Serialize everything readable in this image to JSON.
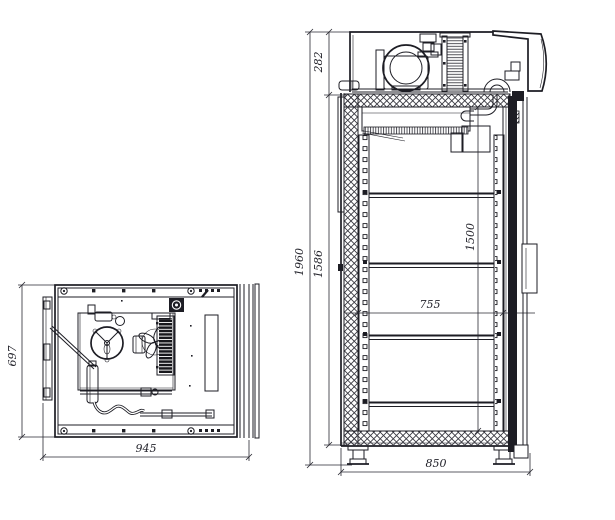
{
  "drawing_title": "Refrigerated cabinet technical drawing — plan view and front section",
  "plan_view": {
    "depth_mm": "697",
    "width_mm": "945"
  },
  "front_section": {
    "machine_compartment_height_mm": "282",
    "overall_height_mm": "1960",
    "body_height_mm": "1586",
    "interior_height_mm": "1500",
    "interior_width_mm": "755",
    "overall_width_mm": "850"
  },
  "colors": {
    "line": "#1d1d24",
    "background": "#ffffff"
  }
}
